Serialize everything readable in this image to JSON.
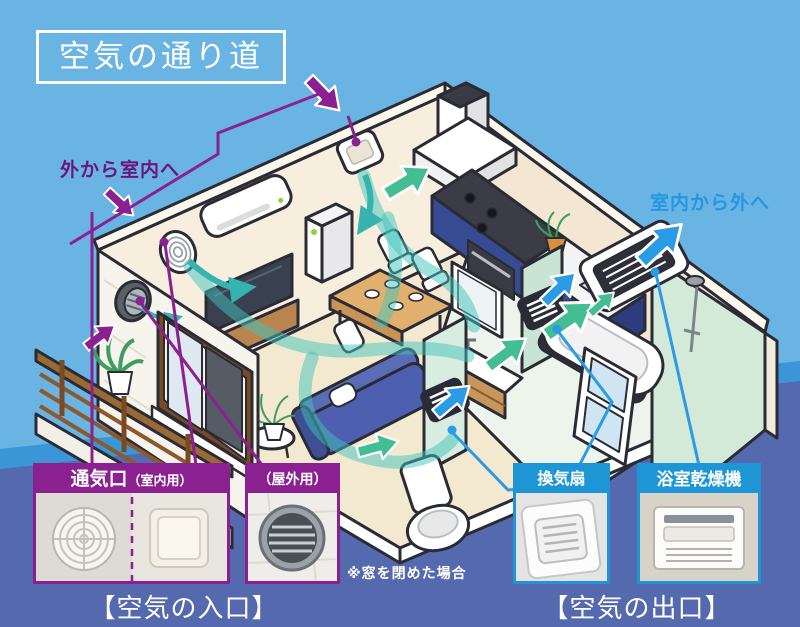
{
  "title": "空気の通り道",
  "flow_labels": {
    "inlet": "外から室内へ",
    "outlet": "室内から外へ"
  },
  "note": "※窓を閉めた場合",
  "inlet_section": {
    "caption": "【空気の入口】",
    "vent_box": {
      "title_main": "通気口",
      "title_sub": "（室内用）"
    },
    "outdoor_box": {
      "title_sub": "（屋外用）"
    }
  },
  "outlet_section": {
    "caption": "【空気の出口】",
    "fan_box": {
      "title": "換気扇"
    },
    "dryer_box": {
      "title": "浴室乾燥機"
    }
  },
  "colors": {
    "sky": "#6ab4e3",
    "band_mid": "#3b96d8",
    "band_bottom": "#5569af",
    "purple": "#8b2190",
    "purple_text": "#6d1578",
    "blue_header": "#1e96d5",
    "blue_arrow": "#2b9be6",
    "green_arrow": "#43bd92",
    "teal_flow": "#35b3ae",
    "outline": "#2b2b36"
  },
  "scene": {
    "icons": [
      "air-conditioner",
      "round-wall-vent",
      "square-wall-vent",
      "outdoor-round-vent",
      "range-hood",
      "kitchen-counter",
      "dining-table",
      "chair",
      "sofa",
      "tv",
      "air-purifier",
      "house-plant",
      "balcony-railing",
      "window",
      "toilet",
      "wall-grille-vent",
      "washbasin",
      "mirror-cabinet",
      "bathtub",
      "shower",
      "bathroom-door",
      "ceiling-dryer-unit",
      "airflow-ribbon",
      "inlet-arrow",
      "outlet-arrow",
      "flow-arrow"
    ]
  }
}
